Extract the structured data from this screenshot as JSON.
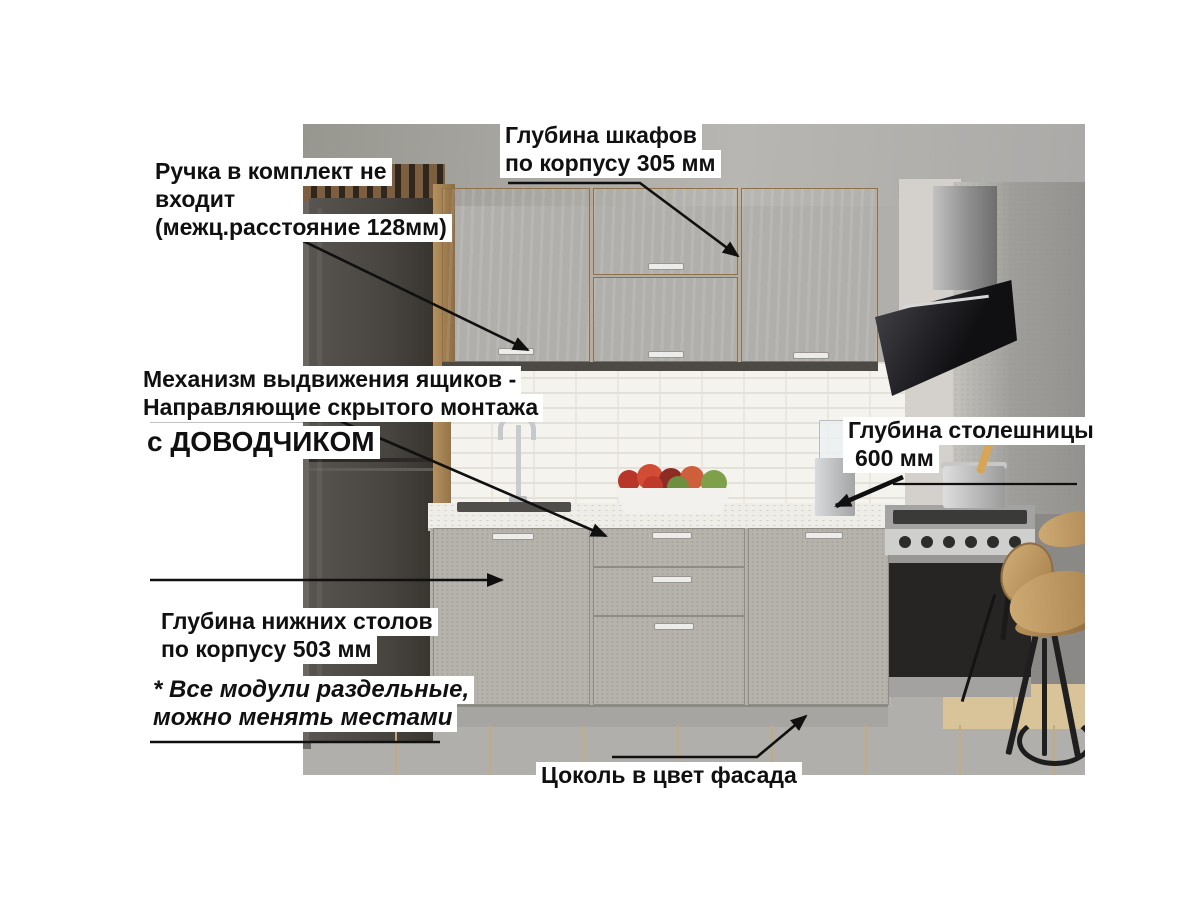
{
  "title": "Схема кухни с размерами",
  "annotations": {
    "cabinet_depth": {
      "line1": "Глубина шкафов",
      "line2": "по корпусу 305 мм"
    },
    "handle_note": {
      "line1": "Ручка в комплект не",
      "line2": "входит",
      "line3": "(межц.расстояние 128мм)"
    },
    "drawer_mechanism": {
      "line1": "Механизм выдвижения ящиков -",
      "line2": "Направляющие скрытого монтажа",
      "emphasis": "с ДОВОДЧИКОМ"
    },
    "countertop_depth": {
      "line1": "Глубина столешницы",
      "line2": "600 мм"
    },
    "base_depth": {
      "line1": "Глубина нижних столов",
      "line2": "по корпусу 503 мм"
    },
    "modules_note": {
      "line1": "* Все модули раздельные,",
      "line2": "можно менять местами"
    },
    "plinth_note": {
      "line1": "Цоколь в цвет фасада"
    }
  },
  "colors": {
    "annotation_text": "#101010",
    "annotation_background": "#ffffff",
    "arrow": "#101010",
    "upper_cabinet_wood": "#c2a070",
    "base_cabinet_concrete": "#b6b3ad",
    "countertop": "#efede7",
    "fridge": "#47433f",
    "hood": "#101013",
    "floor_wood": "#dcc69c",
    "tile": "#f5f3ee"
  }
}
